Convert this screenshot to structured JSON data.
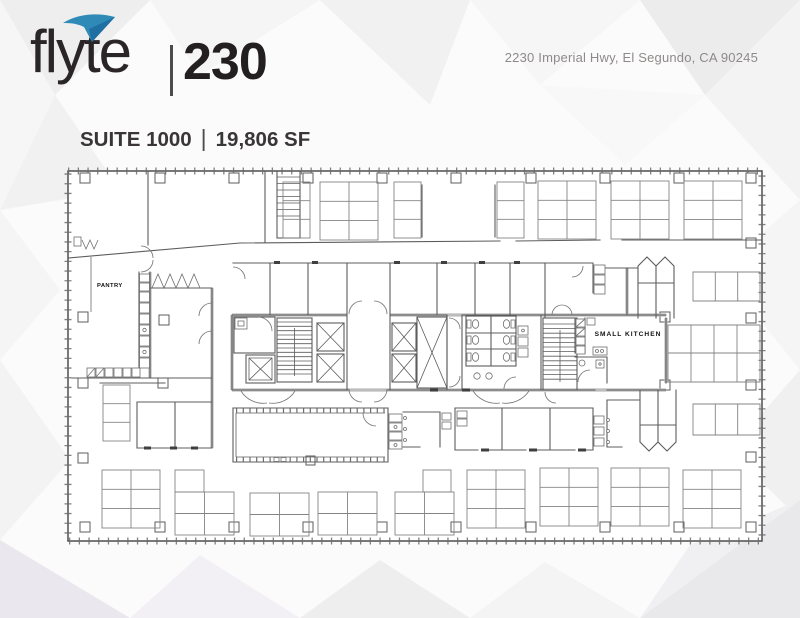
{
  "header": {
    "logo": {
      "brand": "flyte",
      "number": "230",
      "swoosh_color": "#2f8ab8"
    },
    "address": "2230 Imperial Hwy, El Segundo, CA 90245"
  },
  "title": {
    "suite": "SUITE 1000",
    "separator": "|",
    "area": "19,806 SF"
  },
  "floor_plan": {
    "labels": {
      "pantry": "PANTRY",
      "small_kitchen": "SMALL KITCHEN"
    },
    "colors": {
      "wall": "#5c5c5c",
      "furniture": "#848484",
      "label_text": "#111111"
    }
  }
}
